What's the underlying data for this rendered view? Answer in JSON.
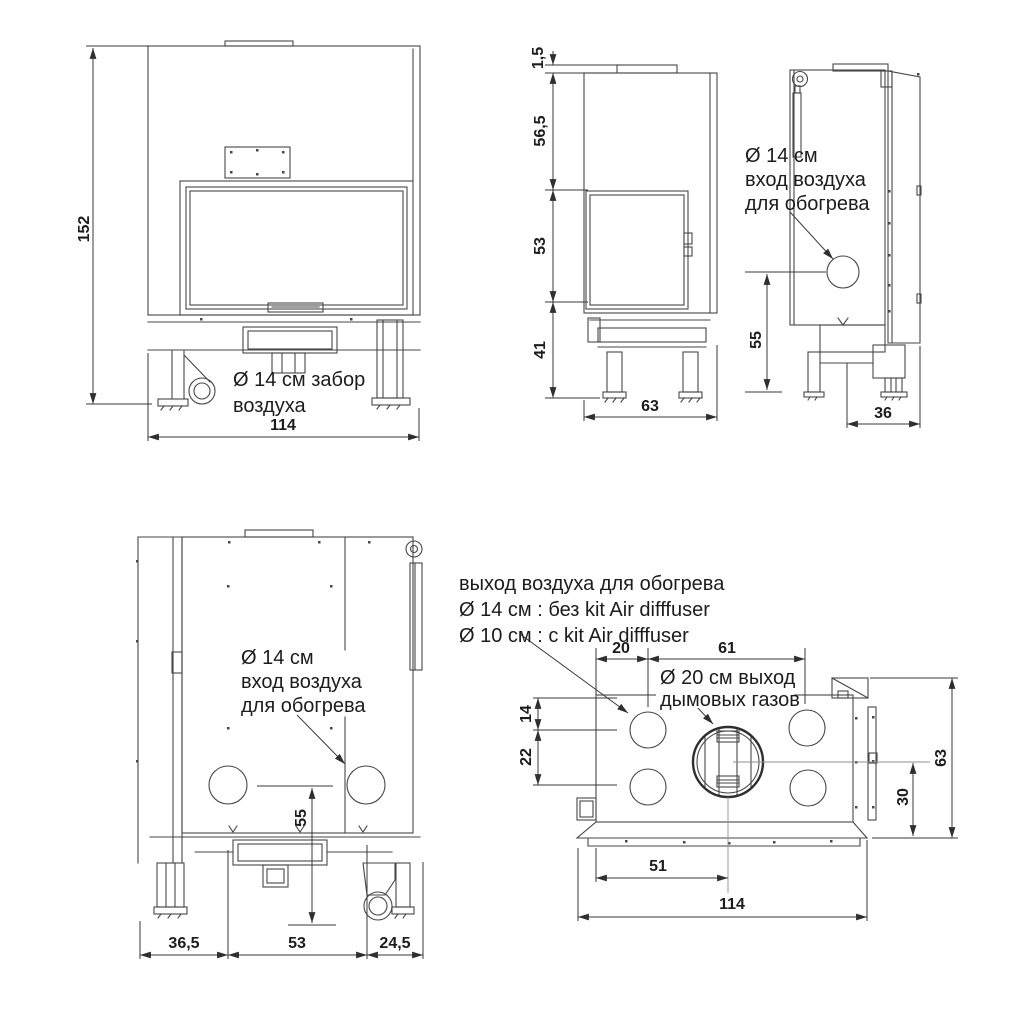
{
  "colors": {
    "background": "#ffffff",
    "line": "#474747",
    "text": "#1c1c1c"
  },
  "views": {
    "front": {
      "dim_height": "152",
      "dim_width": "114",
      "note": [
        "Ø 14 см забор",
        "воздуха"
      ]
    },
    "side": {
      "dim_collar": "1,5",
      "dim_hood": "56,5",
      "dim_door": "53",
      "dim_base": "41",
      "dim_depth": "63"
    },
    "rear_side": {
      "note": [
        "Ø 14 см",
        "вход воздуха",
        "для обогрева"
      ],
      "dim_inlet_height": "55",
      "dim_offset": "36"
    },
    "rear": {
      "note": [
        "Ø 14 см",
        "вход воздуха",
        "для обогрева"
      ],
      "dim_inlet_height": "55",
      "dim_left": "36,5",
      "dim_center": "53",
      "dim_right": "24,5"
    },
    "top": {
      "note": [
        "выход воздуха для обогрева",
        "Ø 14 см : без kit Air difffuser",
        "Ø 10 см : с kit Air difffuser"
      ],
      "flue_note": [
        "Ø 20 см выход",
        "дымовых газов"
      ],
      "dim_top_left": "20",
      "dim_top_right": "61",
      "dim_side_upper": "14",
      "dim_side_lower": "22",
      "dim_right_total": "63",
      "dim_right_inner": "30",
      "dim_bottom_inner": "51",
      "dim_bottom_total": "114"
    }
  }
}
